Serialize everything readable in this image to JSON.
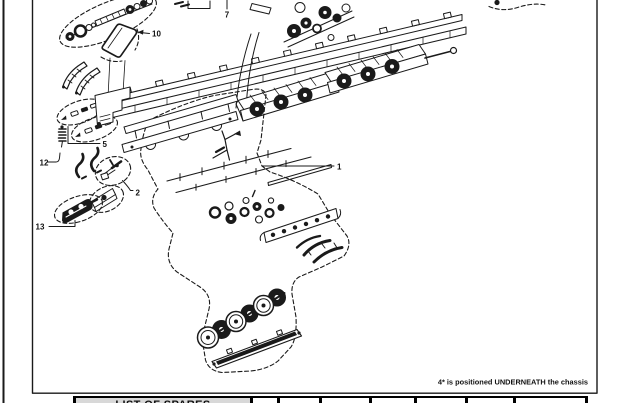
{
  "figure": {
    "note": "4* is positioned UNDERNEATH the chassis",
    "callouts": {
      "c1": "1",
      "c2": "2",
      "c5": "5",
      "c7": "7",
      "c10": "10",
      "c12": "12",
      "c13": "13"
    }
  },
  "table": {
    "title": "LIST OF SPARES"
  },
  "colors": {
    "ink": "#1a1a1a",
    "table_header_bg": "#d8d8d8",
    "page_bg": "#ffffff"
  }
}
